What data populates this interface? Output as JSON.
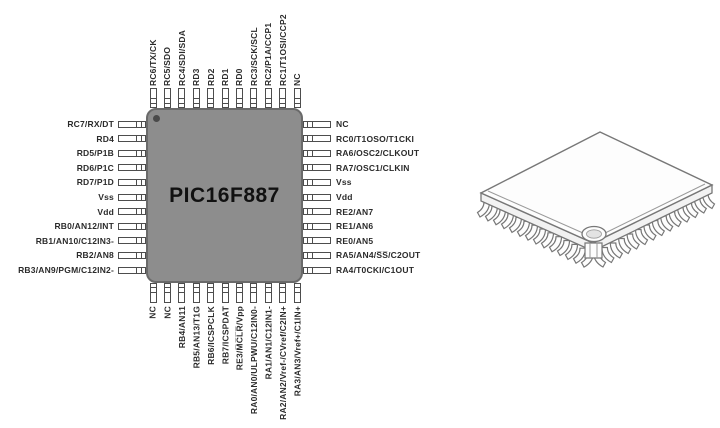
{
  "figure": {
    "chip": {
      "part_number": "PIC16F887",
      "body_color": "#8d8d8d",
      "body_border_color": "#6a6a6a",
      "name_color": "#111111"
    },
    "pin_label_color": "#2b2b2b",
    "pins": {
      "top": [
        "RC6/TX/CK",
        "RC5/SDO",
        "RC4/SDI/SDA",
        "RD3",
        "RD2",
        "RD1",
        "RD0",
        "RC3/SCK/SCL",
        "RC2/P1A/CCP1",
        "RC1/T1OSI/CCP2",
        "NC"
      ],
      "left": [
        "RC7/RX/DT",
        "RD4",
        "RD5/P1B",
        "RD6/P1C",
        "RD7/P1D",
        "Vss",
        "Vdd",
        "RB0/AN12/INT",
        "RB1/AN10/C12IN3-",
        "RB2/AN8",
        "RB3/AN9/PGM/C12IN2-"
      ],
      "right": [
        "NC",
        "RC0/T1OSO/T1CKI",
        "RA6/OSC2/CLKOUT",
        "RA7/OSC1/CLKIN",
        "Vss",
        "Vdd",
        "RE2/AN7",
        "RE1/AN6",
        "RE0/AN5",
        "RA5/AN4/S̅S̅/C2OUT",
        "RA4/T0CKI/C1OUT"
      ],
      "bottom": [
        "NC",
        "NC",
        "RB4/AN11",
        "RB5/AN13/T1G",
        "RB6/ICSPCLK",
        "RB7/ICSPDAT",
        "RE3/M̅C̅L̅R̅/Vpp",
        "RA0/AN0/ULPWU/C12IN0-",
        "RA1/AN1/C12IN1-",
        "RA2/AN2/Vref-/CVref/C2IN+",
        "RA3/AN3/Vref+/C1IN+"
      ]
    },
    "illustration": "qfp-44-package-3d"
  }
}
